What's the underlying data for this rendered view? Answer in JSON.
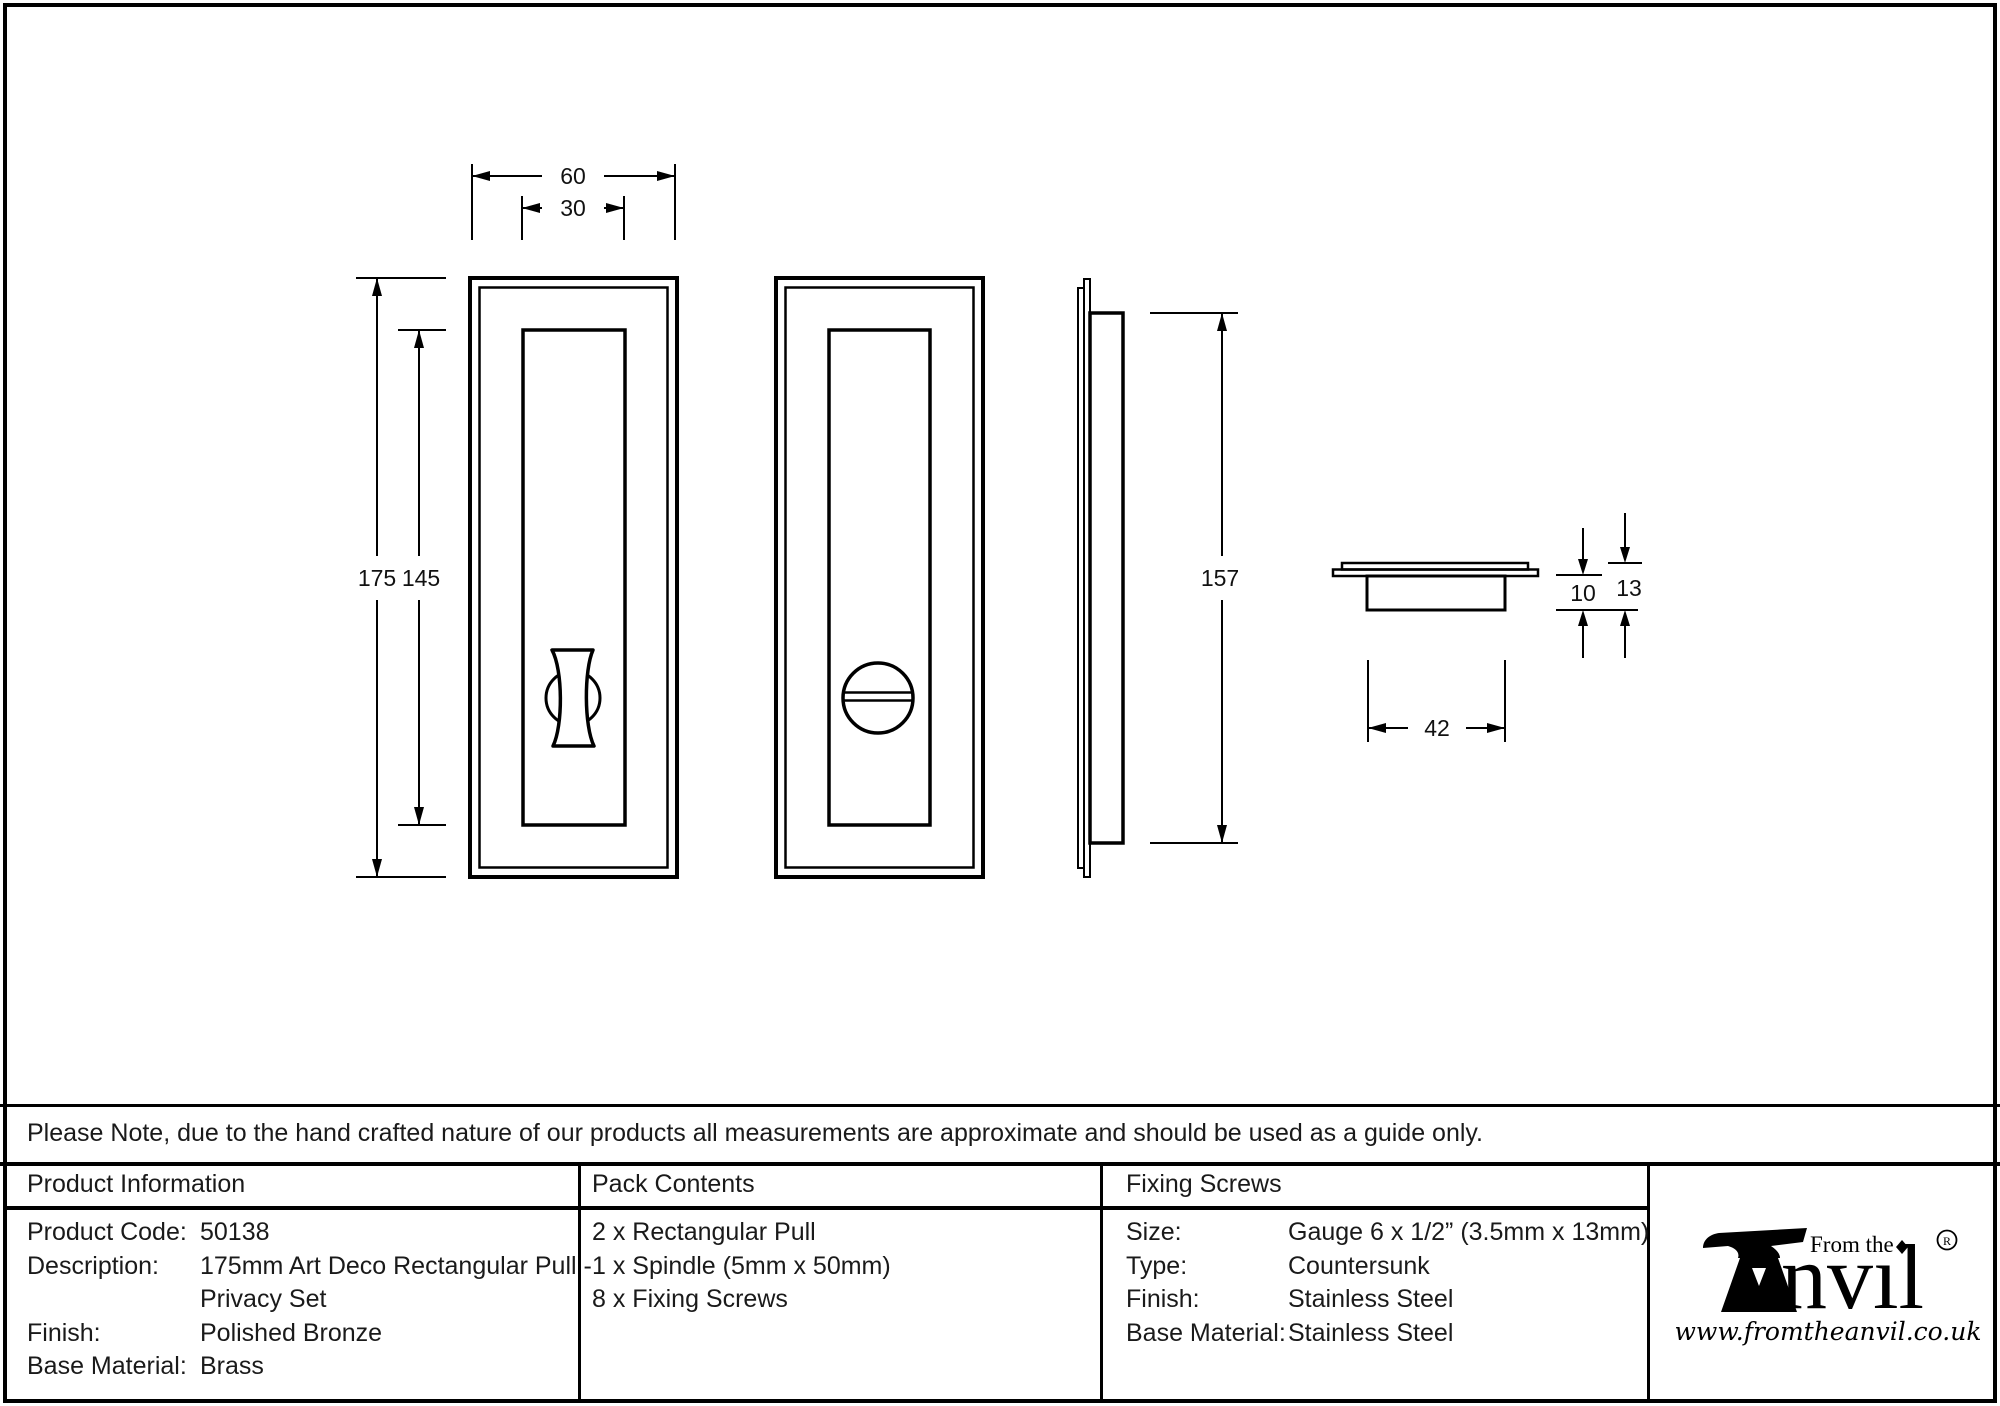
{
  "colors": {
    "line": "#000000",
    "text": "#1a1a1a",
    "background": "#ffffff"
  },
  "note": "Please Note, due to the hand crafted nature of our products all measurements are approximate and should be used as a guide only.",
  "drawing": {
    "dimensions": {
      "outer_width": "60",
      "inner_width": "30",
      "outer_height": "175",
      "inner_height": "145",
      "backbox_height": "157",
      "recess_depth": "10",
      "total_depth": "13",
      "backbox_width": "42"
    }
  },
  "product_info": {
    "title": "Product Information",
    "rows": [
      {
        "label": "Product Code:",
        "value": "50138"
      },
      {
        "label": "Description:",
        "value": "175mm Art Deco Rectangular Pull -"
      },
      {
        "label": "",
        "value": "Privacy Set"
      },
      {
        "label": "Finish:",
        "value": "Polished Bronze"
      },
      {
        "label": "Base Material:",
        "value": "Brass"
      }
    ]
  },
  "pack_contents": {
    "title": "Pack Contents",
    "items": [
      "2 x Rectangular Pull",
      "1 x Spindle (5mm x 50mm)",
      "8 x Fixing Screws"
    ]
  },
  "fixing_screws": {
    "title": "Fixing Screws",
    "rows": [
      {
        "label": "Size:",
        "value": "Gauge 6 x 1/2” (3.5mm x 13mm)"
      },
      {
        "label": "Type:",
        "value": "Countersunk"
      },
      {
        "label": "Finish:",
        "value": "Stainless Steel"
      },
      {
        "label": "Base Material:",
        "value": "Stainless Steel"
      }
    ]
  },
  "logo": {
    "tagline": "From the",
    "brand_suffix": "nvıl",
    "registered_symbol": "R",
    "website": "www.fromtheanvil.co.uk"
  }
}
